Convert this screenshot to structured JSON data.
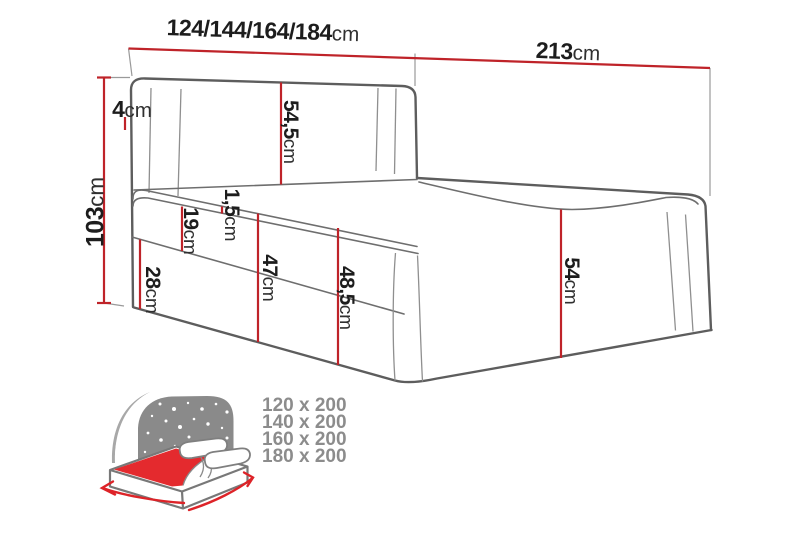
{
  "diagram_type": "bed-dimension-diagram",
  "dimensions": {
    "width_options": {
      "value": "124/144/164/184",
      "unit": "cm"
    },
    "length": {
      "value": "213",
      "unit": "cm"
    },
    "total_height": {
      "value": "103",
      "unit": "cm"
    },
    "headboard_side": {
      "value": "4",
      "unit": "cm"
    },
    "headboard_height": {
      "value": "54,5",
      "unit": "cm"
    },
    "topper": {
      "value": "1,5",
      "unit": "cm"
    },
    "mattress": {
      "value": "19",
      "unit": "cm"
    },
    "base": {
      "value": "28",
      "unit": "cm"
    },
    "side_front": {
      "value": "47",
      "unit": "cm"
    },
    "side_corner": {
      "value": "48,5",
      "unit": "cm"
    },
    "footboard": {
      "value": "54",
      "unit": "cm"
    }
  },
  "size_variants": [
    "120 x 200",
    "140 x 200",
    "160 x 200",
    "180 x 200"
  ],
  "colors": {
    "dimension_line": "#bf2329",
    "accent_red": "#e42a2e",
    "line_art": "#5d5d5d",
    "seam_gray": "#8f8f8f",
    "label_text": "#1d1d1d",
    "legend_text": "#8c8c8c",
    "icon_gray": "#8a8a8a"
  }
}
